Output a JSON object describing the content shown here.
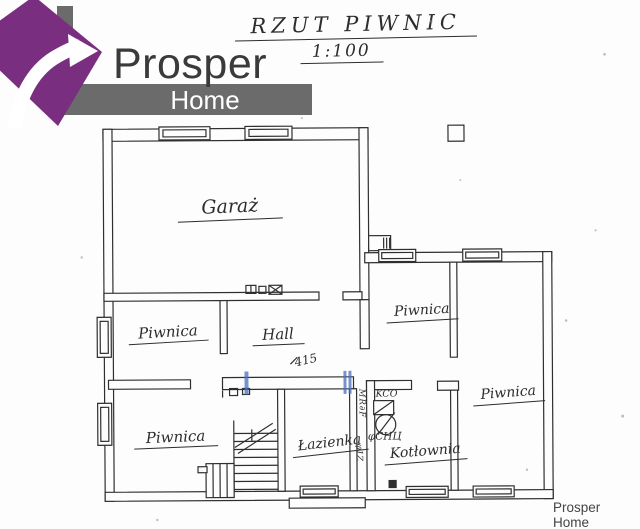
{
  "logo": {
    "brand_top": "Prosper",
    "brand_bottom": "Home",
    "purple": "#7a2e80",
    "bar_gray": "#6b6b6b"
  },
  "title": {
    "line1": "RZUT PIWNIC",
    "line2": "1:100"
  },
  "plan": {
    "ink_color": "#2f2f2f",
    "highlight_color": "#4a6fbd",
    "rooms": [
      {
        "name": "garaz",
        "label": "Garaż"
      },
      {
        "name": "piwnica-mid-left",
        "label": "Piwnica"
      },
      {
        "name": "hall",
        "label": "Hall"
      },
      {
        "name": "piwnica-upper-right",
        "label": "Piwnica"
      },
      {
        "name": "piwnica-bottom-left",
        "label": "Piwnica"
      },
      {
        "name": "lazienka",
        "label": "Łazienka"
      },
      {
        "name": "kotlownia",
        "label": "Kotłownia"
      },
      {
        "name": "piwnica-lower-right",
        "label": "Piwnica"
      }
    ],
    "annotations": [
      {
        "name": "dimension-415",
        "text": "415"
      },
      {
        "name": "kco-note",
        "text": "KCO"
      },
      {
        "name": "pchu-note",
        "text": "φCHЦ"
      },
      {
        "name": "vertical-note-1",
        "text": "MR∂F"
      },
      {
        "name": "vertical-note-2",
        "text": "φ1Z"
      }
    ]
  },
  "footer": {
    "watermark": "Prosper Home"
  }
}
